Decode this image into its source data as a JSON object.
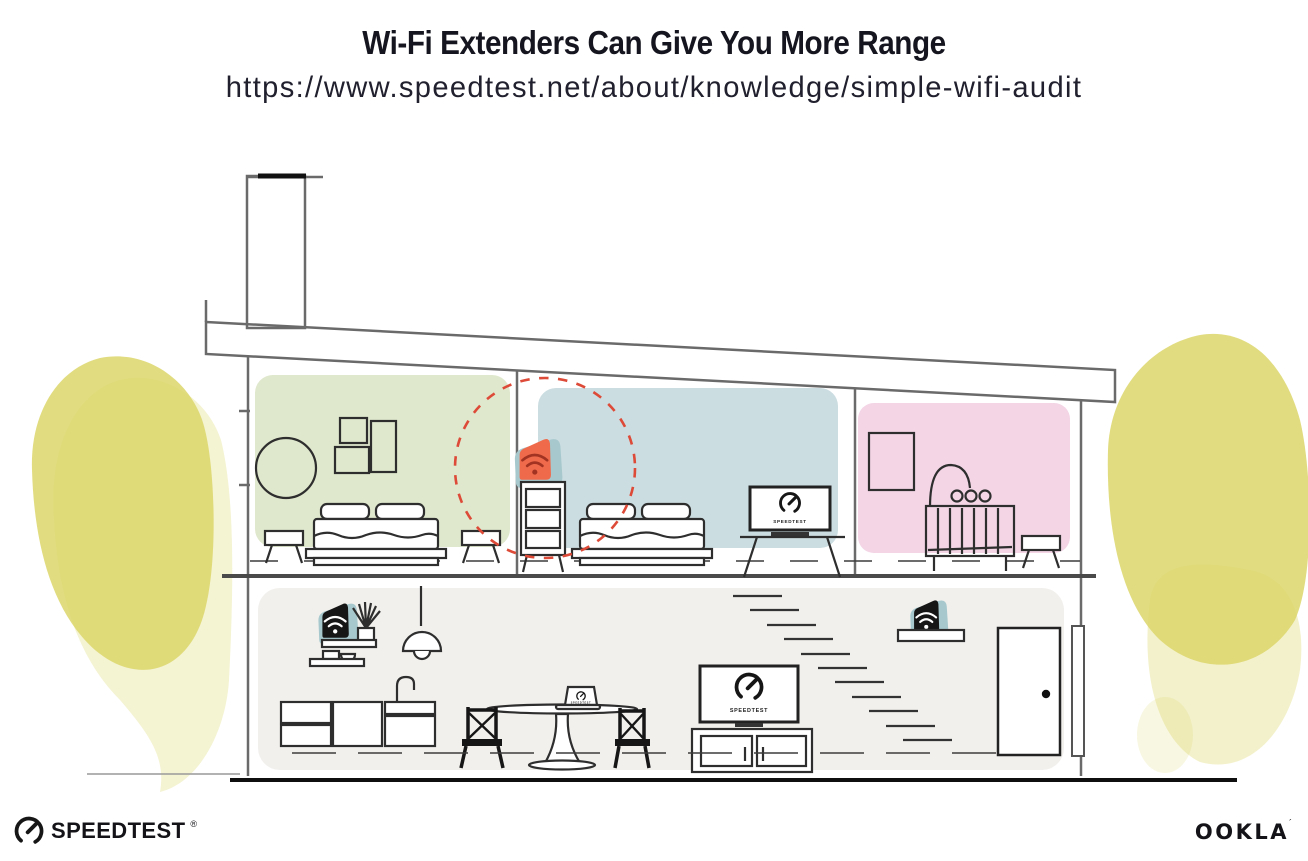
{
  "header": {
    "title": "Wi-Fi Extenders Can Give You More Range",
    "url": "https://www.speedtest.net/about/knowledge/simple-wifi-audit"
  },
  "branding": {
    "speedtest_wordmark": "SPEEDTEST",
    "speedtest_registered_mark": "®",
    "ookla_wordmark": "OOKLA",
    "ookla_trademark_mark": "´"
  },
  "illustration": {
    "tv_screen_label": "SPEEDTEST",
    "laptop_screen_label": "SPEEDTEST",
    "rooms": [
      {
        "name": "bedroom-left",
        "fill": "#dfe7cc"
      },
      {
        "name": "bedroom-center",
        "fill": "#ccdde1"
      },
      {
        "name": "nursery",
        "fill": "#f3d5e6"
      },
      {
        "name": "downstairs-living-area",
        "fill": "#f2f0ed"
      }
    ],
    "devices": [
      {
        "name": "wifi-extender-bedroom",
        "body_color": "#ee6a4b",
        "pad_color": "#a7c9ce",
        "icon": "wifi"
      },
      {
        "name": "wifi-router-kitchen",
        "body_color": "#161616",
        "pad_color": "#a7c9ce",
        "icon": "wifi"
      },
      {
        "name": "wifi-extender-hallway",
        "body_color": "#161616",
        "pad_color": "#a7c9ce",
        "icon": "wifi"
      }
    ],
    "range_circle_color": "#dd4a37",
    "foliage_color": "#dcd66a"
  }
}
